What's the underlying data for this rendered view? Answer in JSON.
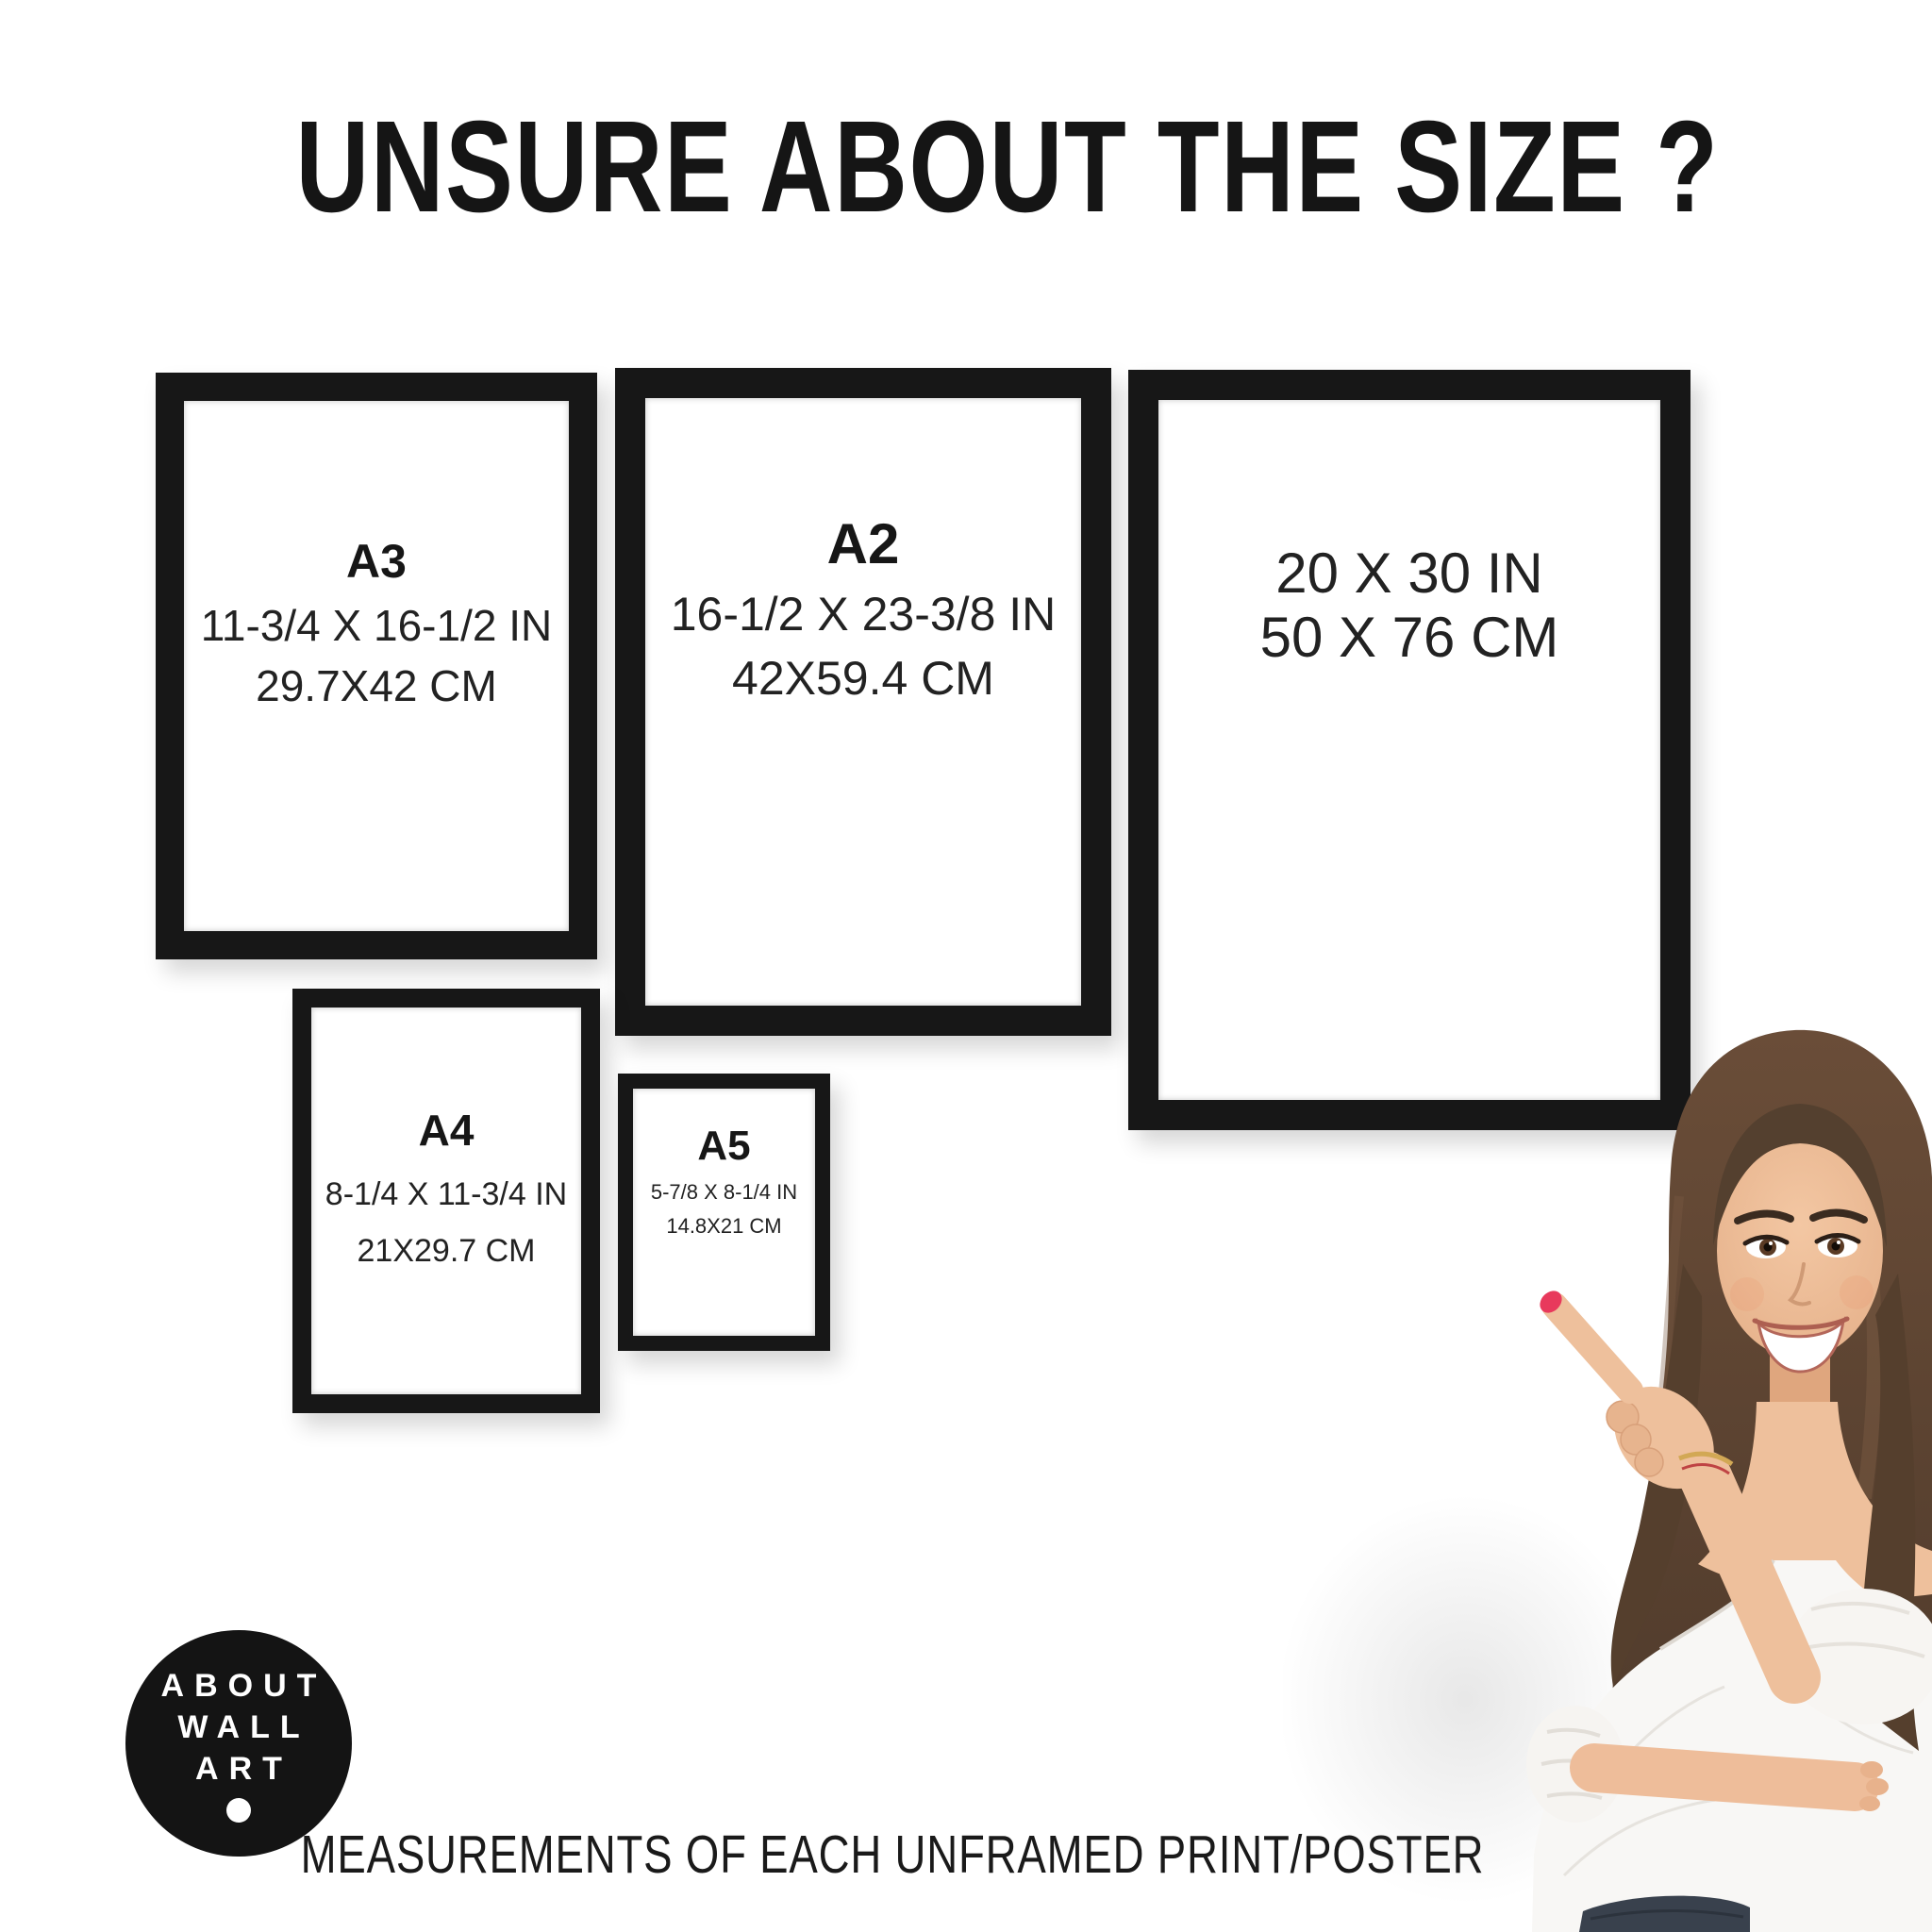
{
  "title": "UNSURE ABOUT THE SIZE ?",
  "frames": [
    {
      "name": "A3",
      "inches": "11-3/4 X 16-1/2 IN",
      "cm": "29.7X42 CM"
    },
    {
      "name": "A2",
      "inches": "16-1/2 X 23-3/8 IN",
      "cm": "42X59.4 CM"
    },
    {
      "name": "",
      "inches": "20 X 30 IN",
      "cm": "50 X 76 CM"
    },
    {
      "name": "A4",
      "inches": "8-1/4 X 11-3/4 IN",
      "cm": "21X29.7 CM"
    },
    {
      "name": "A5",
      "inches": "5-7/8 X 8-1/4 IN",
      "cm": "14.8X21 CM"
    }
  ],
  "logo": {
    "lines": [
      "ABOUT",
      "WALL",
      "ART"
    ]
  },
  "footer": "MEASUREMENTS OF EACH UNFRAMED PRINT/POSTER",
  "colors": {
    "background": "#ffffff",
    "frame_black": "#171717",
    "text_black": "#1d1d1d",
    "logo_bg": "#141414",
    "logo_text": "#ffffff",
    "nail_red": "#e8395c"
  }
}
